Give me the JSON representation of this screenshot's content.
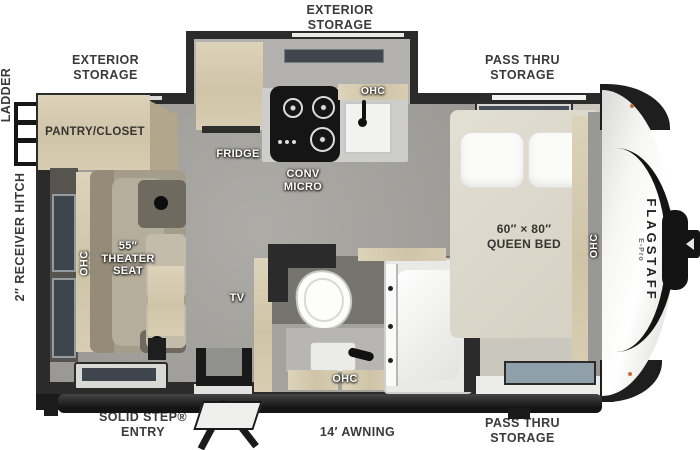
{
  "colors": {
    "wall": "#2b2b2b",
    "floor": "#a2a09b",
    "bedroom_floor": "#cac7be",
    "wood_cabinet": "#d6ccb3",
    "counter": "#cdcdcb",
    "sofa": "#a59d8b",
    "window_glass": "#3e454d",
    "label_dark": "#3a3a3a",
    "clearance_light": "#c0703c"
  },
  "exterior_labels": {
    "storage_top": {
      "line1": "EXTERIOR",
      "line2": "STORAGE"
    },
    "storage_rear": {
      "line1": "EXTERIOR",
      "line2": "STORAGE"
    },
    "pass_thru_top": {
      "line1": "PASS THRU",
      "line2": "STORAGE"
    },
    "pass_thru_bottom": {
      "line1": "PASS THRU",
      "line2": "STORAGE"
    },
    "ladder": "LADDER",
    "receiver_hitch": "2″ RECEIVER HITCH",
    "solid_step": {
      "line1": "SOLID STEP®",
      "line2": "ENTRY"
    },
    "awning": "14′ AWNING"
  },
  "interior_labels": {
    "pantry": "PANTRY/CLOSET",
    "fridge": "FRIDGE",
    "conv_micro": {
      "line1": "CONV",
      "line2": "MICRO"
    },
    "ohc_kitchen": "OHC",
    "ohc_sofa": "OHC",
    "ohc_bath": "OHC",
    "ohc_bed": "OHC",
    "theater_seat": {
      "line1": "55″",
      "line2": "THEATER",
      "line3": "SEAT"
    },
    "tv": "TV",
    "queen_bed": {
      "line1": "60″ × 80″",
      "line2": "QUEEN BED"
    }
  },
  "brand": {
    "name": "FLAGSTAFF",
    "model": "E-Pro"
  }
}
